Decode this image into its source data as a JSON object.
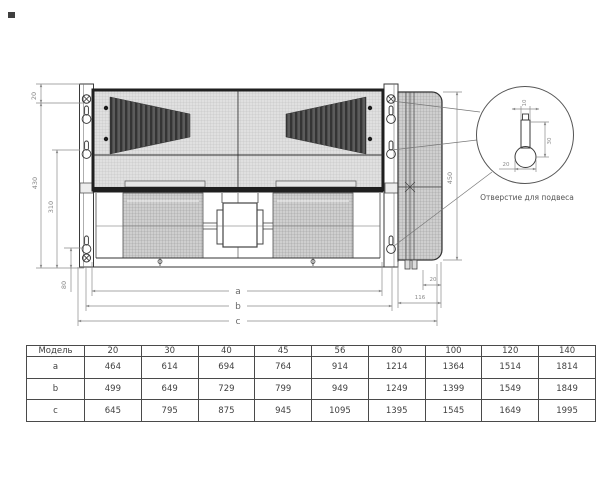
{
  "drawing": {
    "dims": {
      "top_offset": "20",
      "height_total": "430",
      "height_inner": "310",
      "bottom_offset": "80",
      "side_height": "450",
      "side_tab_offset": "20",
      "side_depth": "116",
      "span_a": "a",
      "span_b": "b",
      "span_c": "c"
    },
    "detail": {
      "slot_width": "10",
      "slot_height": "30",
      "hole_diameter": "20",
      "caption": "Отверстие для подвеса"
    }
  },
  "table": {
    "header": [
      "Модель",
      "20",
      "30",
      "40",
      "45",
      "56",
      "80",
      "100",
      "120",
      "140"
    ],
    "rows": [
      {
        "label": "a",
        "values": [
          "464",
          "614",
          "694",
          "764",
          "914",
          "1214",
          "1364",
          "1514",
          "1814"
        ]
      },
      {
        "label": "b",
        "values": [
          "499",
          "649",
          "729",
          "799",
          "949",
          "1249",
          "1399",
          "1549",
          "1849"
        ]
      },
      {
        "label": "c",
        "values": [
          "645",
          "795",
          "875",
          "945",
          "1095",
          "1395",
          "1545",
          "1649",
          "1995"
        ]
      }
    ]
  },
  "colors": {
    "object_line": "#2e2e2e",
    "dim_line": "#8a8a8a",
    "table_text": "#3f3f3f"
  }
}
